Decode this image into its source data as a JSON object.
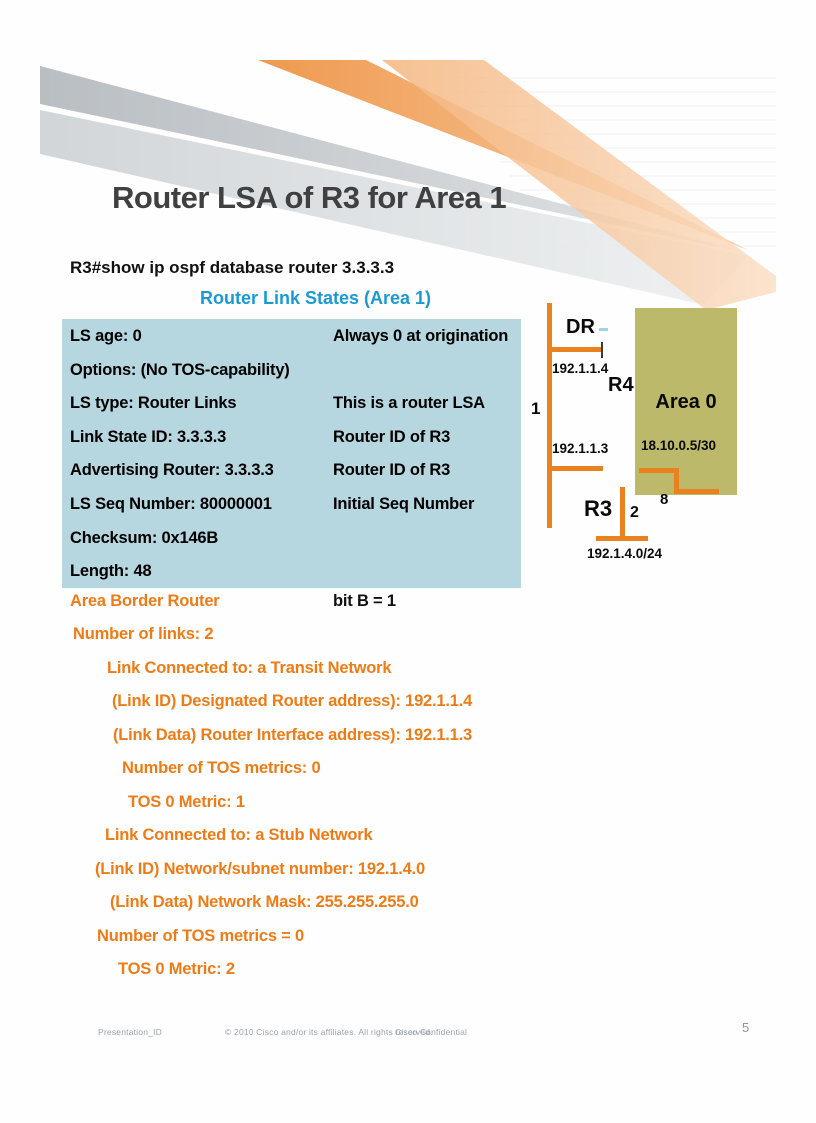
{
  "colors": {
    "accent_orange": "#ED7C17",
    "heading_blue": "#1A9AD2",
    "lsa_box_fill": "#B7D7E0",
    "area0_fill": "#BDB96A",
    "link_orange": "#E8821E",
    "title_gray": "#404040"
  },
  "header": {
    "title": "Router LSA of R3 for Area 1"
  },
  "console": {
    "command": "R3#show ip ospf database router 3.3.3.3",
    "section_heading": "Router Link States (Area 1)"
  },
  "lsa": {
    "rows": [
      {
        "left": "LS age: 0",
        "right": "Always 0 at origination"
      },
      {
        "left": "Options: (No TOS-capability)",
        "right": ""
      },
      {
        "left": "LS type: Router Links",
        "right": "This is a router LSA"
      },
      {
        "left": "Link State ID: 3.3.3.3",
        "right": "Router ID of R3"
      },
      {
        "left": "Advertising Router: 3.3.3.3",
        "right": "Router ID of R3"
      },
      {
        "left": "LS Seq Number: 80000001",
        "right": "Initial Seq Number"
      },
      {
        "left": "Checksum: 0x146B",
        "right": ""
      },
      {
        "left": "Length: 48",
        "right": ""
      }
    ],
    "abr": {
      "left": "Area Border Router",
      "right": "bit B = 1"
    },
    "details": [
      "Number of links: 2",
      "Link Connected to: a Transit Network",
      "(Link ID) Designated Router address): 192.1.1.4",
      "(Link Data) Router Interface address): 192.1.1.3",
      "Number of TOS metrics: 0",
      "TOS 0 Metric: 1",
      "Link Connected to: a Stub Network",
      "(Link ID) Network/subnet number:  192.1.4.0",
      "(Link Data) Network Mask: 255.255.255.0",
      "Number of TOS metrics = 0",
      "TOS 0 Metric: 2"
    ]
  },
  "diagram": {
    "dr_label": "DR",
    "cost_1": "1",
    "ip_dr": "192.1.1.4",
    "r4_label": "R4",
    "ip_r3_interface": "192.1.1.3",
    "area0_label": "Area 0",
    "area0_network": "18.10.0.5/30",
    "cost_8": "8",
    "r3_label": "R3",
    "cost_2": "2",
    "stub_network": "192.1.4.0/24"
  },
  "footer": {
    "presentation_id": "Presentation_ID",
    "copyright": "© 2010 Cisco and/or its affiliates. All rights reserved.",
    "confidential": "Cisco Confidential",
    "page_number": "5"
  }
}
